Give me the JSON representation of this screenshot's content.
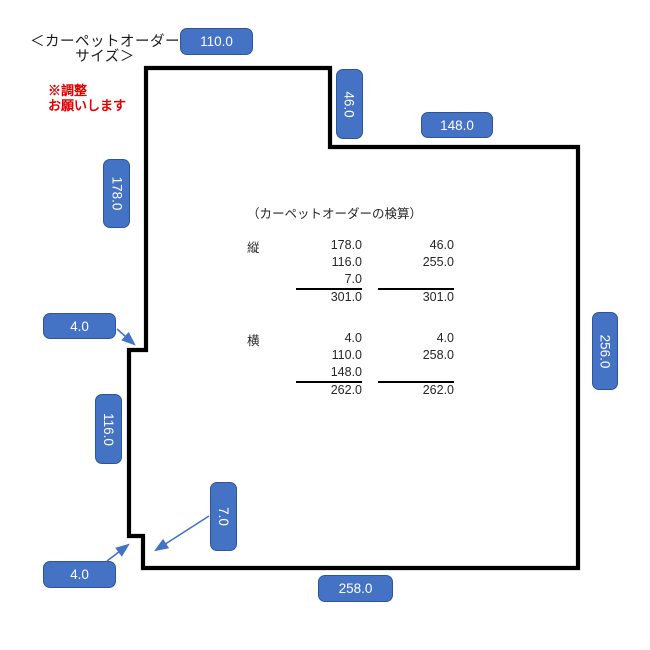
{
  "title": {
    "line1": "＜カーペットオーダー",
    "line2": "サイズ＞"
  },
  "note": {
    "line1": "※調整",
    "line2": "お願いします"
  },
  "dims": {
    "top_left_width": "110.0",
    "top_notch_height": "46.0",
    "top_right_width": "148.0",
    "left_upper_height": "178.0",
    "left_upper_step": "4.0",
    "left_mid_height": "116.0",
    "bottom_left_height": "7.0",
    "left_lower_step": "4.0",
    "bottom_width": "258.0",
    "right_height": "256.0"
  },
  "verification": {
    "heading": "（カーペットオーダーの検算）",
    "vertical": {
      "label": "縦",
      "col1": [
        "178.0",
        "116.0",
        "7.0"
      ],
      "col1_total": "301.0",
      "col2": [
        "46.0",
        "255.0",
        ""
      ],
      "col2_total": "301.0"
    },
    "horizontal": {
      "label": "横",
      "col1": [
        "4.0",
        "110.0",
        "148.0"
      ],
      "col1_total": "262.0",
      "col2": [
        "4.0",
        "258.0",
        ""
      ],
      "col2_total": "262.0"
    }
  },
  "colors": {
    "badge_bg": "#4472C4",
    "badge_border": "#2F5597",
    "badge_text": "#FFFFFF",
    "outline": "#000000",
    "arrow": "#4472C4",
    "note_red": "#E00000"
  }
}
